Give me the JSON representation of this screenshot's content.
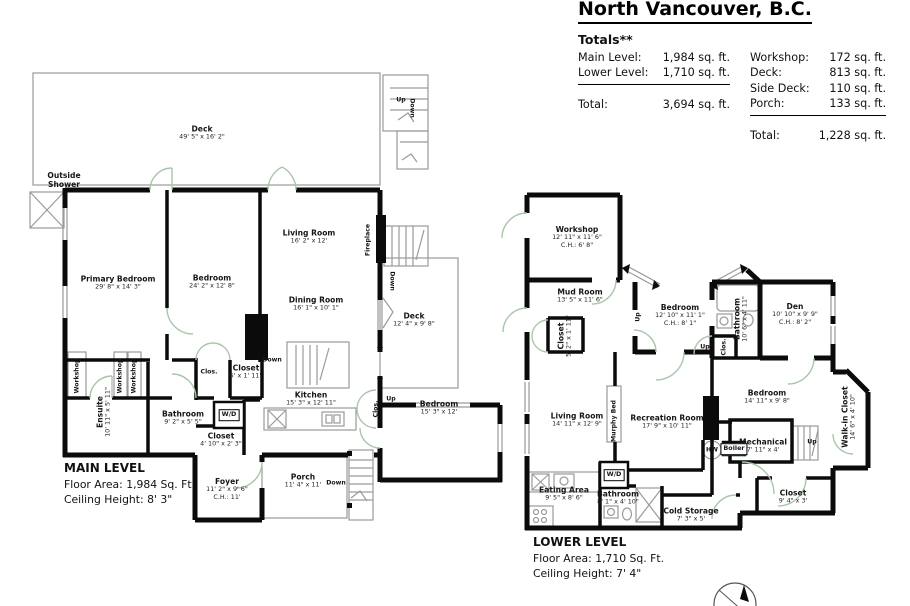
{
  "header": {
    "title": "North Vancouver, B.C.",
    "totals_heading": "Totals**",
    "left_rows": [
      {
        "label": "Main Level:",
        "value": "1,984 sq. ft."
      },
      {
        "label": "Lower Level:",
        "value": "1,710 sq. ft."
      }
    ],
    "left_total": {
      "label": "Total:",
      "value": "3,694 sq. ft."
    },
    "right_rows": [
      {
        "label": "Workshop:",
        "value": "172 sq. ft."
      },
      {
        "label": "Deck:",
        "value": "813 sq. ft."
      },
      {
        "label": "Side Deck:",
        "value": "110 sq. ft."
      },
      {
        "label": "Porch:",
        "value": "133 sq. ft."
      }
    ],
    "right_total": {
      "label": "Total:",
      "value": "1,228 sq. ft."
    }
  },
  "main_level": {
    "title": "MAIN LEVEL",
    "floor_area": "Floor Area: 1,984 Sq. Ft.",
    "ceiling_height": "Ceiling Height: 8' 3\"",
    "labels": [
      {
        "name": "Deck",
        "dims": "49' 5\" x 16' 2\"",
        "x": 202,
        "y": 133
      },
      {
        "name": "Outside Shower",
        "x": 64,
        "y": 180,
        "w": 48
      },
      {
        "name": "Up",
        "x": 401,
        "y": 100,
        "cls": "tiny"
      },
      {
        "name": "Down",
        "x": 412,
        "y": 108,
        "cls": "tiny",
        "rot": 90
      },
      {
        "name": "Primary Bedroom",
        "dims": "29' 8\" x 14' 3\"",
        "x": 118,
        "y": 283
      },
      {
        "name": "Bedroom",
        "dims": "24' 2\" x 12' 8\"",
        "x": 212,
        "y": 282
      },
      {
        "name": "Living Room",
        "dims": "16' 2\" x 12'",
        "x": 309,
        "y": 237
      },
      {
        "name": "Fireplace",
        "x": 368,
        "y": 240,
        "cls": "tiny",
        "rot": -90
      },
      {
        "name": "Down",
        "x": 392,
        "y": 281,
        "cls": "tiny",
        "rot": 90
      },
      {
        "name": "Dining Room",
        "dims": "16' 1\" x 10' 1\"",
        "x": 316,
        "y": 304
      },
      {
        "name": "Deck",
        "dims": "12' 4\" x 9' 8\"",
        "x": 414,
        "y": 320
      },
      {
        "name": "Clos.",
        "x": 209,
        "y": 372,
        "cls": "tiny"
      },
      {
        "name": "Closet",
        "dims": "5' x 1' 11\"",
        "x": 246,
        "y": 372
      },
      {
        "name": "Down",
        "x": 272,
        "y": 360,
        "cls": "tiny"
      },
      {
        "name": "Kitchen",
        "dims": "15' 3\" x 12' 11\"",
        "x": 311,
        "y": 399
      },
      {
        "name": "Clos.",
        "x": 376,
        "y": 409,
        "cls": "tiny",
        "rot": -90
      },
      {
        "name": "Up",
        "x": 391,
        "y": 399,
        "cls": "tiny"
      },
      {
        "name": "Workshop",
        "x": 77,
        "y": 376,
        "cls": "tiny",
        "rot": -90
      },
      {
        "name": "Workshop",
        "x": 120,
        "y": 376,
        "cls": "tiny",
        "rot": -90
      },
      {
        "name": "Workshop",
        "x": 134,
        "y": 376,
        "cls": "tiny",
        "rot": -90
      },
      {
        "name": "Ensuite",
        "dims": "10' 11\" x 5' 11\"",
        "x": 104,
        "y": 412,
        "rot": -90
      },
      {
        "name": "Bathroom",
        "dims": "9' 2\" x 5' 5\"",
        "x": 183,
        "y": 418
      },
      {
        "name": "W/D",
        "x": 229,
        "y": 415,
        "cls": "boxed"
      },
      {
        "name": "Closet",
        "dims": "4' 10\" x 2' 3\"",
        "x": 221,
        "y": 440
      },
      {
        "name": "Bedroom",
        "dims": "15' 3\" x 12'",
        "x": 439,
        "y": 408
      },
      {
        "name": "Foyer",
        "dims": "11' 2\" x 9' 6\"",
        "ch": "C.H.: 11'",
        "x": 227,
        "y": 489
      },
      {
        "name": "Porch",
        "dims": "11' 4\" x 11'",
        "x": 303,
        "y": 481
      },
      {
        "name": "Down",
        "x": 336,
        "y": 483,
        "cls": "tiny"
      }
    ]
  },
  "lower_level": {
    "title": "LOWER LEVEL",
    "floor_area": "Floor Area: 1,710 Sq. Ft.",
    "ceiling_height": "Ceiling Height: 7' 4\"",
    "labels": [
      {
        "name": "Workshop",
        "dims": "12' 11\" x 11' 6\"",
        "ch": "C.H.: 6' 8\"",
        "x": 577,
        "y": 237
      },
      {
        "name": "Mud Room",
        "dims": "13' 5\" x 11' 6\"",
        "x": 580,
        "y": 296
      },
      {
        "name": "Closet",
        "dims": "5' 2\" x 1' 11\"",
        "x": 565,
        "y": 336,
        "rot": -90
      },
      {
        "name": "Bedroom",
        "dims": "12' 10\" x 11' 1\"",
        "ch": "C.H.: 8' 1\"",
        "x": 680,
        "y": 315
      },
      {
        "name": "Up",
        "x": 638,
        "y": 317,
        "cls": "tiny",
        "rot": -90
      },
      {
        "name": "Den",
        "dims": "10' 10\" x 9' 9\"",
        "ch": "C.H.: 8' 2\"",
        "x": 795,
        "y": 314
      },
      {
        "name": "Bathroom",
        "dims": "10' 6\" x 4' 11\"",
        "x": 741,
        "y": 319,
        "rot": -90
      },
      {
        "name": "Clos.",
        "x": 724,
        "y": 347,
        "cls": "tiny",
        "rot": -90
      },
      {
        "name": "Up",
        "x": 705,
        "y": 347,
        "cls": "tiny"
      },
      {
        "name": "Living Room",
        "dims": "14' 11\" x 12' 9\"",
        "x": 577,
        "y": 420
      },
      {
        "name": "Murphy Bed",
        "x": 614,
        "y": 421,
        "cls": "tiny",
        "rot": -90
      },
      {
        "name": "Recreation Room",
        "dims": "17' 9\" x 10' 11\"",
        "x": 667,
        "y": 422
      },
      {
        "name": "Bedroom",
        "dims": "14' 11\" x 9' 8\"",
        "x": 767,
        "y": 397
      },
      {
        "name": "Mechanical",
        "dims": "7' 11\" x 4'",
        "x": 763,
        "y": 446
      },
      {
        "name": "Boiler",
        "x": 734,
        "y": 449,
        "cls": "boxed"
      },
      {
        "name": "HW",
        "x": 712,
        "y": 450,
        "cls": "tiny"
      },
      {
        "name": "Up",
        "x": 812,
        "y": 442,
        "cls": "tiny"
      },
      {
        "name": "Walk-in Closet",
        "dims": "14' 6\" x 4' 10\"",
        "x": 849,
        "y": 417,
        "rot": -90
      },
      {
        "name": "Closet",
        "dims": "9' 4\" x 3'",
        "x": 793,
        "y": 497
      },
      {
        "name": "Eating Area",
        "dims": "9' 5\" x 8' 6\"",
        "x": 564,
        "y": 494
      },
      {
        "name": "W/D",
        "x": 614,
        "y": 475,
        "cls": "boxed"
      },
      {
        "name": "Bathroom",
        "dims": "8' 1\" x 4' 10\"",
        "x": 618,
        "y": 498
      },
      {
        "name": "Cold Storage",
        "dims": "7' 3\" x 5'",
        "x": 691,
        "y": 515
      }
    ]
  }
}
